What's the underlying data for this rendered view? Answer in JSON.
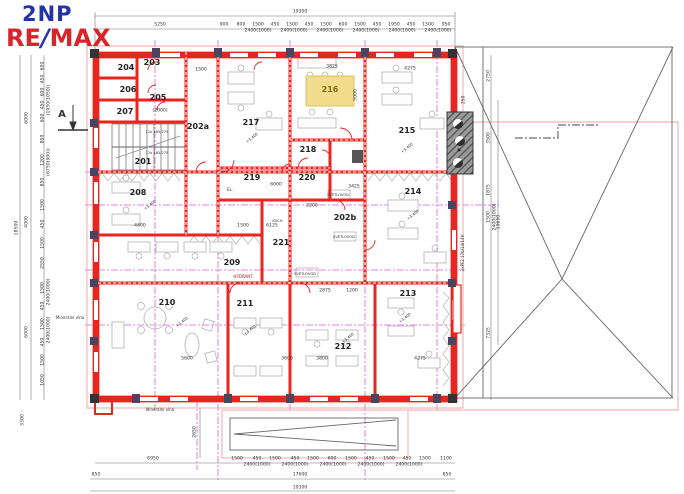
{
  "logo": {
    "floor": "2NP",
    "re": "RE",
    "slash": "/",
    "max": "MAX"
  },
  "colors": {
    "wall_red": "#e8251f",
    "axis_magenta": "#d95fd9",
    "highlight_yellow": "#f3dc8e",
    "logo_blue": "#2433a8",
    "logo_red": "#d6262c",
    "outline_pink": "#f0a0a0"
  },
  "rooms": [
    {
      "label": "201",
      "x": 143,
      "y": 162
    },
    {
      "label": "202a",
      "x": 198,
      "y": 127
    },
    {
      "label": "202b",
      "x": 345,
      "y": 218
    },
    {
      "label": "203",
      "x": 152,
      "y": 63
    },
    {
      "label": "204",
      "x": 126,
      "y": 68
    },
    {
      "label": "205",
      "x": 158,
      "y": 98
    },
    {
      "label": "206",
      "x": 128,
      "y": 90
    },
    {
      "label": "207",
      "x": 125,
      "y": 112
    },
    {
      "label": "208",
      "x": 138,
      "y": 193
    },
    {
      "label": "209",
      "x": 232,
      "y": 263
    },
    {
      "label": "210",
      "x": 167,
      "y": 303
    },
    {
      "label": "211",
      "x": 245,
      "y": 304
    },
    {
      "label": "212",
      "x": 343,
      "y": 347
    },
    {
      "label": "213",
      "x": 408,
      "y": 294
    },
    {
      "label": "214",
      "x": 413,
      "y": 192
    },
    {
      "label": "215",
      "x": 407,
      "y": 131
    },
    {
      "label": "216",
      "x": 330,
      "y": 90,
      "hl": true
    },
    {
      "label": "217",
      "x": 251,
      "y": 123
    },
    {
      "label": "218",
      "x": 308,
      "y": 150
    },
    {
      "label": "219",
      "x": 252,
      "y": 178
    },
    {
      "label": "220",
      "x": 307,
      "y": 178
    },
    {
      "label": "221",
      "x": 281,
      "y": 243
    }
  ],
  "dim_labels": [
    {
      "text": "19300",
      "x": 300,
      "y": 13
    },
    {
      "text": "5250",
      "x": 160,
      "y": 26
    },
    {
      "text": "900",
      "x": 224,
      "y": 26
    },
    {
      "text": "800",
      "x": 241,
      "y": 26
    },
    {
      "text": "1500",
      "x": 258,
      "y": 26
    },
    {
      "text": "450",
      "x": 275,
      "y": 26
    },
    {
      "text": "1500",
      "x": 292,
      "y": 26
    },
    {
      "text": "450",
      "x": 309,
      "y": 26
    },
    {
      "text": "1500",
      "x": 326,
      "y": 26
    },
    {
      "text": "600",
      "x": 343,
      "y": 26
    },
    {
      "text": "1500",
      "x": 360,
      "y": 26
    },
    {
      "text": "450",
      "x": 377,
      "y": 26
    },
    {
      "text": "1950",
      "x": 394,
      "y": 26
    },
    {
      "text": "450",
      "x": 411,
      "y": 26
    },
    {
      "text": "1500",
      "x": 428,
      "y": 26
    },
    {
      "text": "950",
      "x": 446,
      "y": 26
    },
    {
      "text": "2400(1000)",
      "x": 258,
      "y": 32
    },
    {
      "text": "2400(1000)",
      "x": 294,
      "y": 32
    },
    {
      "text": "2400(1000)",
      "x": 330,
      "y": 32
    },
    {
      "text": "2400(1000)",
      "x": 366,
      "y": 32
    },
    {
      "text": "2400(1000)",
      "x": 402,
      "y": 32
    },
    {
      "text": "2400(1000)",
      "x": 438,
      "y": 32
    },
    {
      "text": "6950",
      "x": 153,
      "y": 460
    },
    {
      "text": "1500",
      "x": 237,
      "y": 460
    },
    {
      "text": "450",
      "x": 257,
      "y": 460
    },
    {
      "text": "1500",
      "x": 275,
      "y": 460
    },
    {
      "text": "450",
      "x": 295,
      "y": 460
    },
    {
      "text": "1500",
      "x": 313,
      "y": 460
    },
    {
      "text": "600",
      "x": 332,
      "y": 460
    },
    {
      "text": "1500",
      "x": 351,
      "y": 460
    },
    {
      "text": "450",
      "x": 370,
      "y": 460
    },
    {
      "text": "1500",
      "x": 389,
      "y": 460
    },
    {
      "text": "450",
      "x": 407,
      "y": 460
    },
    {
      "text": "1500",
      "x": 425,
      "y": 460
    },
    {
      "text": "1100",
      "x": 446,
      "y": 460
    },
    {
      "text": "2400(1000)",
      "x": 257,
      "y": 466
    },
    {
      "text": "2400(1000)",
      "x": 295,
      "y": 466
    },
    {
      "text": "2400(1000)",
      "x": 333,
      "y": 466
    },
    {
      "text": "2400(1000)",
      "x": 371,
      "y": 466
    },
    {
      "text": "2400(1000)",
      "x": 409,
      "y": 466
    },
    {
      "text": "850",
      "x": 96,
      "y": 476
    },
    {
      "text": "17600",
      "x": 300,
      "y": 476
    },
    {
      "text": "850",
      "x": 447,
      "y": 476
    },
    {
      "text": "19300",
      "x": 300,
      "y": 489
    },
    {
      "text": "18500",
      "x": 18,
      "y": 228,
      "rot": -90
    },
    {
      "text": "6000",
      "x": 28,
      "y": 118,
      "rot": -90
    },
    {
      "text": "4000",
      "x": 28,
      "y": 222,
      "rot": -90
    },
    {
      "text": "6000",
      "x": 28,
      "y": 332,
      "rot": -90
    },
    {
      "text": "3300",
      "x": 24,
      "y": 420,
      "rot": -90
    },
    {
      "text": "600",
      "x": 44,
      "y": 66,
      "rot": -90
    },
    {
      "text": "450",
      "x": 44,
      "y": 79,
      "rot": -90
    },
    {
      "text": "600",
      "x": 44,
      "y": 92,
      "rot": -90
    },
    {
      "text": "450",
      "x": 44,
      "y": 105,
      "rot": -90
    },
    {
      "text": "600",
      "x": 44,
      "y": 118,
      "rot": -90
    },
    {
      "text": "850",
      "x": 44,
      "y": 139,
      "rot": -90
    },
    {
      "text": "1200",
      "x": 44,
      "y": 160,
      "rot": -90
    },
    {
      "text": "850",
      "x": 44,
      "y": 182,
      "rot": -90
    },
    {
      "text": "1500",
      "x": 44,
      "y": 205,
      "rot": -90
    },
    {
      "text": "450",
      "x": 44,
      "y": 224,
      "rot": -90
    },
    {
      "text": "1500",
      "x": 44,
      "y": 243,
      "rot": -90
    },
    {
      "text": "2550",
      "x": 44,
      "y": 263,
      "rot": -90
    },
    {
      "text": "1500",
      "x": 44,
      "y": 288,
      "rot": -90
    },
    {
      "text": "450",
      "x": 44,
      "y": 306,
      "rot": -90
    },
    {
      "text": "1500",
      "x": 44,
      "y": 324,
      "rot": -90
    },
    {
      "text": "450",
      "x": 44,
      "y": 342,
      "rot": -90
    },
    {
      "text": "1500",
      "x": 44,
      "y": 360,
      "rot": -90
    },
    {
      "text": "1050",
      "x": 44,
      "y": 380,
      "rot": -90
    },
    {
      "text": "(1950(1050))",
      "x": 50,
      "y": 100,
      "rot": -90
    },
    {
      "text": "(6750(900))",
      "x": 50,
      "y": 162,
      "rot": -90
    },
    {
      "text": "2400(1000)",
      "x": 50,
      "y": 292,
      "rot": -90
    },
    {
      "text": "2400(1000)",
      "x": 50,
      "y": 330,
      "rot": -90
    },
    {
      "text": "350",
      "x": 465,
      "y": 100,
      "rot": -90
    },
    {
      "text": "2750",
      "x": 490,
      "y": 76,
      "rot": -90
    },
    {
      "text": "3500",
      "x": 490,
      "y": 138,
      "rot": -90
    },
    {
      "text": "1875",
      "x": 490,
      "y": 190,
      "rot": -90
    },
    {
      "text": "1500",
      "x": 490,
      "y": 217,
      "rot": -90
    },
    {
      "text": "2400(1000)",
      "x": 496,
      "y": 217,
      "rot": -90
    },
    {
      "text": "19650",
      "x": 500,
      "y": 222,
      "rot": -90
    },
    {
      "text": "7325",
      "x": 490,
      "y": 333,
      "rot": -90
    },
    {
      "text": "2650",
      "x": 196,
      "y": 432,
      "rot": -90
    },
    {
      "text": "4400",
      "x": 140,
      "y": 227
    },
    {
      "text": "1500",
      "x": 243,
      "y": 227
    },
    {
      "text": "5600",
      "x": 187,
      "y": 360
    },
    {
      "text": "3600",
      "x": 287,
      "y": 360
    },
    {
      "text": "3800",
      "x": 322,
      "y": 360
    },
    {
      "text": "4275",
      "x": 420,
      "y": 360
    },
    {
      "text": "6125",
      "x": 272,
      "y": 227
    },
    {
      "text": "6000",
      "x": 276,
      "y": 186
    },
    {
      "text": "2200",
      "x": 312,
      "y": 207
    },
    {
      "text": "3425",
      "x": 354,
      "y": 188
    },
    {
      "text": "5000",
      "x": 357,
      "y": 95,
      "rot": -90
    },
    {
      "text": "4275",
      "x": 410,
      "y": 70
    },
    {
      "text": "3825",
      "x": 332,
      "y": 68
    },
    {
      "text": "2875",
      "x": 325,
      "y": 292
    },
    {
      "text": "1200",
      "x": 352,
      "y": 292
    },
    {
      "text": "(2000)",
      "x": 160,
      "y": 112
    },
    {
      "text": "1500",
      "x": 201,
      "y": 71
    }
  ],
  "annotations": [
    {
      "text": "SVĚTLOVOD",
      "x": 338,
      "y": 196,
      "size": 3.6
    },
    {
      "text": "SVĚTLOVOD",
      "x": 344,
      "y": 238,
      "size": 3.6
    },
    {
      "text": "SVĚTLOVOD",
      "x": 305,
      "y": 275,
      "size": 3.6
    },
    {
      "text": "HYDRANT",
      "x": 243,
      "y": 277,
      "size": 4,
      "color": "#cc1111"
    },
    {
      "text": "Minerální vlna",
      "x": 70,
      "y": 318,
      "size": 4
    },
    {
      "text": "Minerální vlna",
      "x": 160,
      "y": 410,
      "size": 4
    },
    {
      "text": "EL.",
      "x": 230,
      "y": 190,
      "size": 4
    },
    {
      "text": "KUCH.",
      "x": 278,
      "y": 222,
      "size": 3.6
    },
    {
      "text": "A",
      "x": 62,
      "y": 115,
      "size": 10,
      "bold": true
    },
    {
      "text": "12x 165/279",
      "x": 157,
      "y": 133,
      "size": 3.6
    },
    {
      "text": "12x 165/279",
      "x": 157,
      "y": 154,
      "size": 3.6
    },
    {
      "text": "3xPF2 17b/14/14V",
      "x": 463,
      "y": 253,
      "size": 4,
      "rot": -90
    },
    {
      "text": "+3,400",
      "x": 252,
      "y": 138,
      "size": 3.8,
      "rot": -38
    },
    {
      "text": "+3,400",
      "x": 407,
      "y": 148,
      "size": 3.8,
      "rot": -38
    },
    {
      "text": "+3,400",
      "x": 413,
      "y": 215,
      "size": 3.8,
      "rot": -38
    },
    {
      "text": "+3,400",
      "x": 150,
      "y": 205,
      "size": 3.8,
      "rot": -38
    },
    {
      "text": "+3,400",
      "x": 182,
      "y": 322,
      "size": 3.8,
      "rot": -38
    },
    {
      "text": "+3,400",
      "x": 250,
      "y": 330,
      "size": 3.8,
      "rot": -38
    },
    {
      "text": "+3,400",
      "x": 348,
      "y": 338,
      "size": 3.8,
      "rot": -38
    },
    {
      "text": "+3,400",
      "x": 405,
      "y": 318,
      "size": 3.8,
      "rot": -38
    }
  ]
}
